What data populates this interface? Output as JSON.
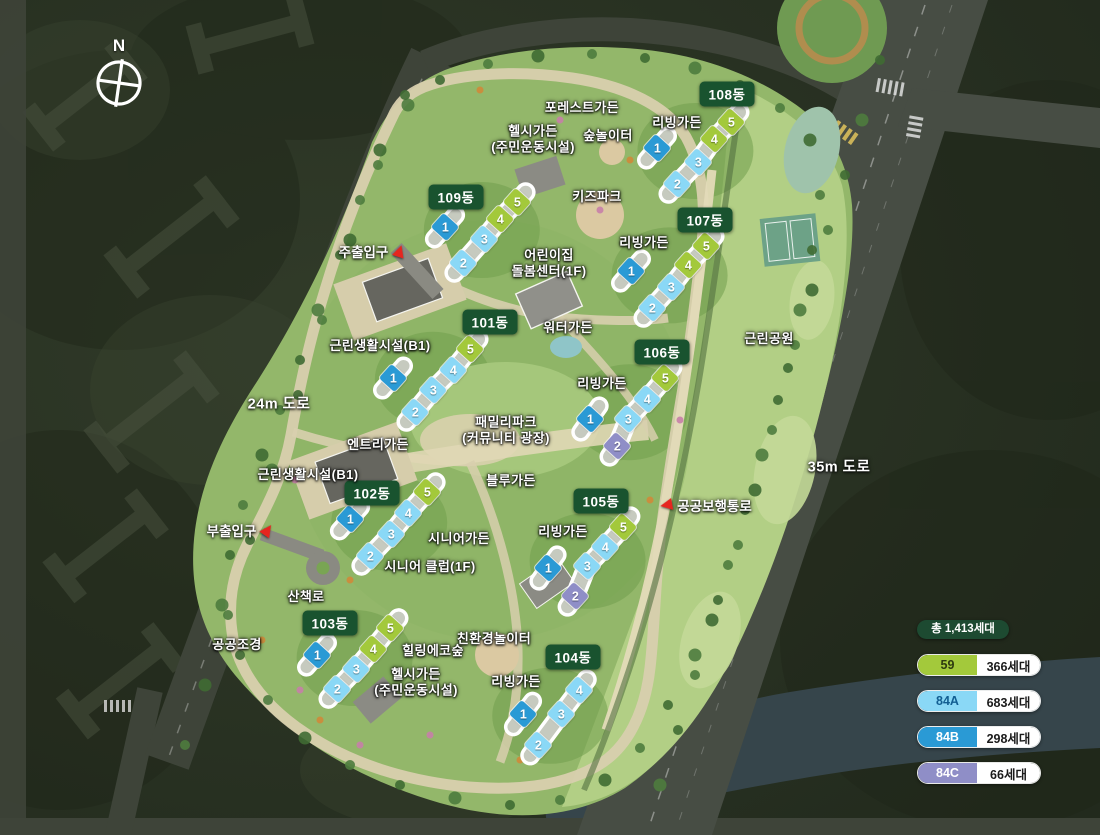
{
  "title": "아파트 단지 배치도",
  "compass": {
    "label": "N"
  },
  "badge_color": "#19532f",
  "unit_types": {
    "59": "#a3c93b",
    "84A": "#8ad8f6",
    "84B": "#2a9ad5",
    "84C": "#8f8ec7"
  },
  "buildings": [
    {
      "name": "101동",
      "label": {
        "x": 490,
        "y": 322
      },
      "units": [
        {
          "no": "1",
          "type": "84B",
          "x": 393,
          "y": 378
        },
        {
          "no": "2",
          "type": "84A",
          "x": 415,
          "y": 412
        },
        {
          "no": "3",
          "type": "84A",
          "x": 433,
          "y": 390
        },
        {
          "no": "4",
          "type": "84A",
          "x": 453,
          "y": 370
        },
        {
          "no": "5",
          "type": "59",
          "x": 470,
          "y": 349
        }
      ]
    },
    {
      "name": "102동",
      "label": {
        "x": 372,
        "y": 493
      },
      "units": [
        {
          "no": "1",
          "type": "84B",
          "x": 350,
          "y": 519
        },
        {
          "no": "2",
          "type": "84A",
          "x": 370,
          "y": 556
        },
        {
          "no": "3",
          "type": "84A",
          "x": 391,
          "y": 534
        },
        {
          "no": "4",
          "type": "84A",
          "x": 408,
          "y": 513
        },
        {
          "no": "5",
          "type": "59",
          "x": 427,
          "y": 492
        }
      ]
    },
    {
      "name": "103동",
      "label": {
        "x": 330,
        "y": 623
      },
      "units": [
        {
          "no": "1",
          "type": "84B",
          "x": 317,
          "y": 655
        },
        {
          "no": "2",
          "type": "84A",
          "x": 337,
          "y": 689
        },
        {
          "no": "3",
          "type": "84A",
          "x": 356,
          "y": 669
        },
        {
          "no": "4",
          "type": "59",
          "x": 373,
          "y": 649
        },
        {
          "no": "5",
          "type": "59",
          "x": 390,
          "y": 628
        }
      ]
    },
    {
      "name": "104동",
      "label": {
        "x": 573,
        "y": 657
      },
      "units": [
        {
          "no": "1",
          "type": "84B",
          "x": 523,
          "y": 714
        },
        {
          "no": "2",
          "type": "84A",
          "x": 538,
          "y": 745
        },
        {
          "no": "3",
          "type": "84A",
          "x": 561,
          "y": 714
        },
        {
          "no": "4",
          "type": "84A",
          "x": 579,
          "y": 690
        }
      ]
    },
    {
      "name": "105동",
      "label": {
        "x": 601,
        "y": 501
      },
      "units": [
        {
          "no": "1",
          "type": "84B",
          "x": 548,
          "y": 568
        },
        {
          "no": "2",
          "type": "84C",
          "x": 575,
          "y": 596
        },
        {
          "no": "3",
          "type": "84A",
          "x": 587,
          "y": 566
        },
        {
          "no": "4",
          "type": "84A",
          "x": 605,
          "y": 547
        },
        {
          "no": "5",
          "type": "59",
          "x": 623,
          "y": 527
        }
      ]
    },
    {
      "name": "106동",
      "label": {
        "x": 662,
        "y": 352
      },
      "units": [
        {
          "no": "1",
          "type": "84B",
          "x": 590,
          "y": 419
        },
        {
          "no": "2",
          "type": "84C",
          "x": 617,
          "y": 446
        },
        {
          "no": "3",
          "type": "84A",
          "x": 628,
          "y": 419
        },
        {
          "no": "4",
          "type": "84A",
          "x": 647,
          "y": 399
        },
        {
          "no": "5",
          "type": "59",
          "x": 665,
          "y": 378
        }
      ]
    },
    {
      "name": "107동",
      "label": {
        "x": 705,
        "y": 220
      },
      "units": [
        {
          "no": "1",
          "type": "84B",
          "x": 631,
          "y": 271
        },
        {
          "no": "2",
          "type": "84A",
          "x": 652,
          "y": 308
        },
        {
          "no": "3",
          "type": "84A",
          "x": 671,
          "y": 287
        },
        {
          "no": "4",
          "type": "59",
          "x": 688,
          "y": 265
        },
        {
          "no": "5",
          "type": "59",
          "x": 706,
          "y": 246
        }
      ]
    },
    {
      "name": "108동",
      "label": {
        "x": 727,
        "y": 94
      },
      "units": [
        {
          "no": "1",
          "type": "84B",
          "x": 657,
          "y": 148
        },
        {
          "no": "2",
          "type": "84A",
          "x": 677,
          "y": 184
        },
        {
          "no": "3",
          "type": "84A",
          "x": 698,
          "y": 162
        },
        {
          "no": "4",
          "type": "59",
          "x": 714,
          "y": 139
        },
        {
          "no": "5",
          "type": "59",
          "x": 731,
          "y": 122
        }
      ]
    },
    {
      "name": "109동",
      "label": {
        "x": 456,
        "y": 197
      },
      "units": [
        {
          "no": "1",
          "type": "84B",
          "x": 445,
          "y": 227
        },
        {
          "no": "2",
          "type": "84A",
          "x": 463,
          "y": 263
        },
        {
          "no": "3",
          "type": "84A",
          "x": 484,
          "y": 239
        },
        {
          "no": "4",
          "type": "59",
          "x": 500,
          "y": 219
        },
        {
          "no": "5",
          "type": "59",
          "x": 517,
          "y": 202
        }
      ]
    }
  ],
  "map_labels": [
    {
      "text": "포레스트가든",
      "x": 582,
      "y": 108
    },
    {
      "text": "헬시가든\n(주민운동시설)",
      "x": 533,
      "y": 139
    },
    {
      "text": "숲놀이터",
      "x": 608,
      "y": 136
    },
    {
      "text": "리빙가든",
      "x": 677,
      "y": 123
    },
    {
      "text": "키즈파크",
      "x": 597,
      "y": 197
    },
    {
      "text": "리빙가든",
      "x": 644,
      "y": 243
    },
    {
      "text": "어린이집\n돌봄센터(1F)",
      "x": 549,
      "y": 263
    },
    {
      "text": "워터가든",
      "x": 568,
      "y": 328
    },
    {
      "text": "근린생활시설(B1)",
      "x": 380,
      "y": 346
    },
    {
      "text": "근린공원",
      "x": 769,
      "y": 339
    },
    {
      "text": "리빙가든",
      "x": 602,
      "y": 384
    },
    {
      "text": "패밀리파크\n(커뮤니티 광장)",
      "x": 506,
      "y": 430
    },
    {
      "text": "엔트리가든",
      "x": 378,
      "y": 445
    },
    {
      "text": "근린생활시설(B1)",
      "x": 308,
      "y": 475
    },
    {
      "text": "블루가든",
      "x": 511,
      "y": 481
    },
    {
      "text": "시니어가든",
      "x": 459,
      "y": 539
    },
    {
      "text": "리빙가든",
      "x": 563,
      "y": 532
    },
    {
      "text": "시니어 클럽(1F)",
      "x": 430,
      "y": 567
    },
    {
      "text": "산책로",
      "x": 306,
      "y": 597
    },
    {
      "text": "공공조경",
      "x": 237,
      "y": 645
    },
    {
      "text": "친환경놀이터",
      "x": 494,
      "y": 639
    },
    {
      "text": "힐링에코숲",
      "x": 433,
      "y": 651
    },
    {
      "text": "헬시가든\n(주민운동시설)",
      "x": 416,
      "y": 682
    },
    {
      "text": "리빙가든",
      "x": 516,
      "y": 682
    }
  ],
  "road_labels": [
    {
      "text": "24m 도로",
      "x": 279,
      "y": 403
    },
    {
      "text": "35m 도로",
      "x": 839,
      "y": 466
    }
  ],
  "entrances": [
    {
      "text": "주출입구",
      "x": 372,
      "y": 251,
      "arrow": "up",
      "arrow_side": "right",
      "rotate": 18
    },
    {
      "text": "부출입구",
      "x": 240,
      "y": 530,
      "arrow": "up",
      "arrow_side": "right",
      "rotate": 35
    },
    {
      "text": "공공보행통로",
      "x": 706,
      "y": 505,
      "arrow": "left",
      "arrow_side": "left",
      "rotate": -10
    }
  ],
  "legend": {
    "total": "총 1,413세대",
    "total_bg": "#1d4a31",
    "rows": [
      {
        "type": "59",
        "count": "366세대",
        "color": "#a3c93b",
        "text_color": "#2e3b10"
      },
      {
        "type": "84A",
        "count": "683세대",
        "color": "#8ad8f6",
        "text_color": "#125e92"
      },
      {
        "type": "84B",
        "count": "298세대",
        "color": "#2a9ad5",
        "text_color": "#ffffff"
      },
      {
        "type": "84C",
        "count": "66세대",
        "color": "#8f8ec7",
        "text_color": "#ffffff"
      }
    ]
  }
}
